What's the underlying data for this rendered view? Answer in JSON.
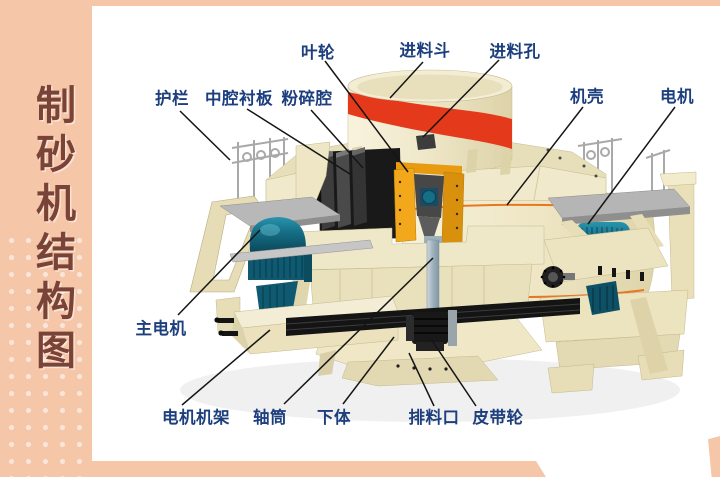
{
  "page": {
    "background": "#ffffff",
    "accent_salmon": "#f6c6a9"
  },
  "sidebar": {
    "title": "制砂机结构图",
    "text_color": "#7a4337",
    "bg": "#f6c6a9"
  },
  "diagram": {
    "label_color": "#1d3f7e",
    "line_color": "#151515",
    "parts": [
      {
        "id": "impeller",
        "label": "叶轮",
        "at": [
          318,
          51
        ],
        "line": [
          325,
          61,
          408,
          172
        ]
      },
      {
        "id": "feed-hopper",
        "label": "进料斗",
        "at": [
          425,
          49
        ],
        "line": [
          423,
          62,
          390,
          98
        ]
      },
      {
        "id": "feed-hole",
        "label": "进料孔",
        "at": [
          515,
          50
        ],
        "line": [
          499,
          60,
          423,
          137
        ]
      },
      {
        "id": "guardrail",
        "label": "护栏",
        "at": [
          172,
          97
        ],
        "line": [
          180,
          111,
          230,
          160
        ]
      },
      {
        "id": "cavity-liner",
        "label": "中腔衬板",
        "at": [
          239,
          97
        ],
        "line": [
          247,
          109,
          350,
          174
        ]
      },
      {
        "id": "crushing-chamber",
        "label": "粉碎腔",
        "at": [
          307,
          97
        ],
        "line": [
          311,
          110,
          363,
          168
        ]
      },
      {
        "id": "casing",
        "label": "机壳",
        "at": [
          587,
          95
        ],
        "line": [
          583,
          107,
          507,
          205
        ]
      },
      {
        "id": "motor",
        "label": "电机",
        "at": [
          677,
          95
        ],
        "line": [
          675,
          107,
          588,
          224
        ]
      },
      {
        "id": "main-motor",
        "label": "主电机",
        "at": [
          161,
          327
        ],
        "line": [
          178,
          315,
          260,
          230
        ]
      },
      {
        "id": "motor-frame",
        "label": "电机机架",
        "at": [
          196,
          416
        ],
        "line": [
          182,
          405,
          270,
          330
        ]
      },
      {
        "id": "shaft-tube",
        "label": "轴筒",
        "at": [
          270,
          416
        ],
        "line": [
          284,
          404,
          433,
          258
        ]
      },
      {
        "id": "lower-body",
        "label": "下体",
        "at": [
          334,
          416
        ],
        "line": [
          343,
          404,
          394,
          337
        ]
      },
      {
        "id": "discharge-port",
        "label": "排料口",
        "at": [
          434,
          416
        ],
        "line": [
          434,
          406,
          409,
          353
        ]
      },
      {
        "id": "belt-pulley",
        "label": "皮带轮",
        "at": [
          498,
          416
        ],
        "line": [
          476,
          406,
          431,
          339
        ]
      }
    ]
  },
  "machine": {
    "palette": {
      "cream": "#efe8c8",
      "cream_dark": "#ddd3a9",
      "red_band": "#e5391b",
      "orange_trim": "#e87722",
      "impeller_orange": "#f2a81a",
      "liner_dark": "#3d3d3d",
      "teal_motor": "#156f86",
      "deck_gray": "#b5b5b5",
      "shaft_gray": "#a9b8c2",
      "belt_black": "#141414"
    }
  }
}
